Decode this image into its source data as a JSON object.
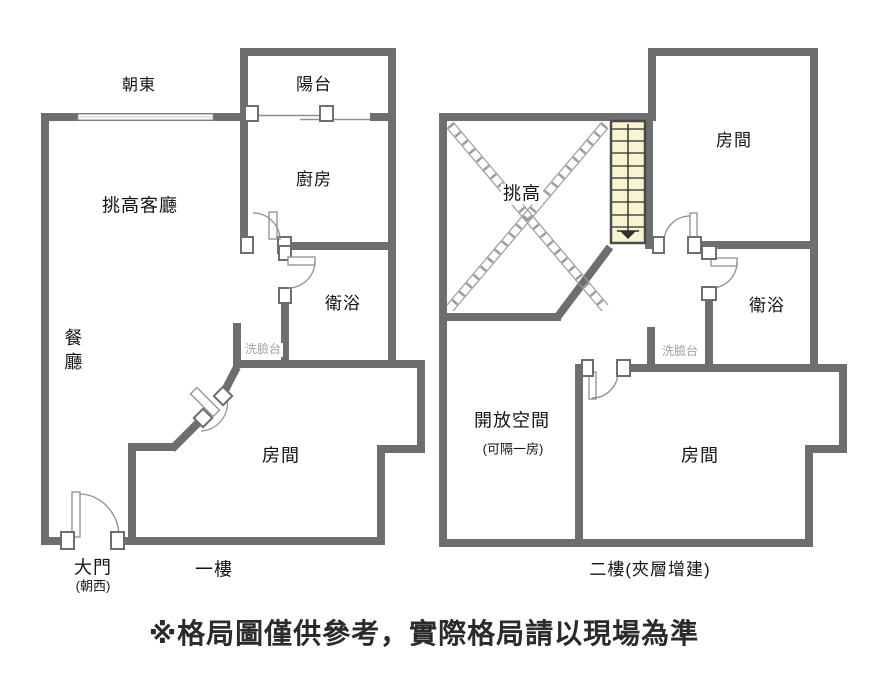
{
  "colors": {
    "wall": "#6e6e6e",
    "door_line": "#8f8f8f",
    "stair_fill": "#f8f4d0",
    "stair_line": "#4a4a4a",
    "hatch_line": "#9c9c9c",
    "label": "#151515",
    "muted_label": "#a3a3a3"
  },
  "floor1": {
    "title": "一樓",
    "direction": "朝東",
    "balcony": "陽台",
    "kitchen": "廚房",
    "living": "挑高客廳",
    "dining": "餐廳",
    "bath": "衛浴",
    "basin": "洗臉台",
    "bedroom": "房間",
    "door": "大門",
    "door_facing": "(朝西)"
  },
  "floor2": {
    "title": "二樓(夾層增建)",
    "void": "挑高",
    "room_top": "房間",
    "bath": "衛浴",
    "basin": "洗臉台",
    "open_space": "開放空間",
    "open_space_note": "(可隔一房)",
    "room_bottom": "房間"
  },
  "footer": {
    "disclaimer": "※格局圖僅供參考，實際格局請以現場為準"
  }
}
